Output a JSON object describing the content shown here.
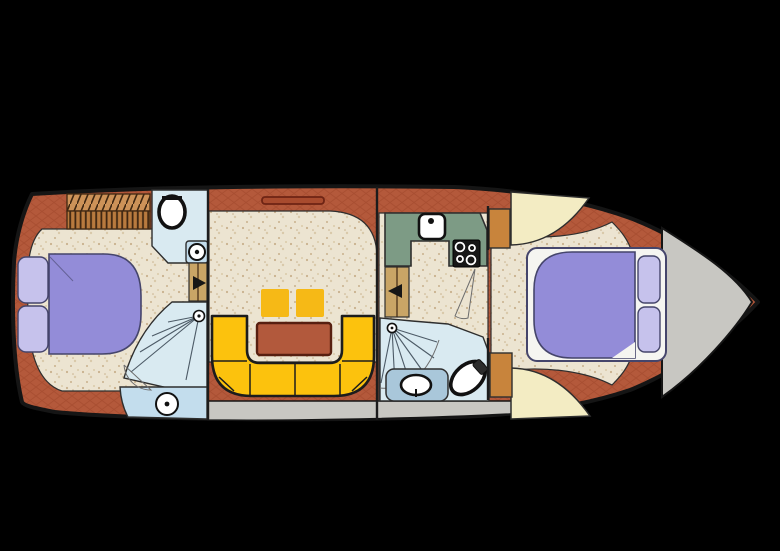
{
  "figure": {
    "kind": "yacht-deck-floor-plan",
    "orientation": "bow-right",
    "visible_text": "",
    "sections": {
      "aft_cabin": {
        "furniture": [
          "double-bed",
          "pillows",
          "louvered-steps",
          "wc-room",
          "toilet",
          "wash-basin",
          "fan-staircase",
          "shower-room",
          "deck-support"
        ]
      },
      "salon": {
        "furniture": [
          "u-shaped-sofa",
          "dinette-table",
          "two-stools",
          "vent-slot"
        ]
      },
      "galley_bathroom": {
        "furniture": [
          "galley-counter",
          "sink",
          "stove",
          "fan-staircase",
          "wash-basin-counter",
          "toilet",
          "cabinet-doors"
        ]
      },
      "bow_cabin": {
        "furniture": [
          "double-bed",
          "pillows",
          "wardrobe-wedges",
          "cabinet-doors"
        ]
      },
      "bow_deck": {
        "furniture": []
      }
    }
  },
  "palette": {
    "background": "#000000",
    "hull_outline": "#151515",
    "terracotta": "#b4593b",
    "terracotta_line": "#9a4226",
    "deck_gray": "#c8c7c2",
    "floor_beige": "#ece4d1",
    "speckle1": "#c9b18d",
    "speckle2": "#d9c9a9",
    "room_blue": "#d9eaf1",
    "shower_blue": "#c3dded",
    "counter_blue": "#a9c7da",
    "bed_purple": "#938cd8",
    "pillow_lilac": "#c6c2ec",
    "bed_frame": "#f5f5f1",
    "bed_outline": "#45456b",
    "sofa_yellow": "#fcc20d",
    "stool_yellow": "#f6b916",
    "sofa_outline": "#1c1c1c",
    "table_brown": "#b2593c",
    "table_border": "#571f10",
    "galley_green": "#7d9b85",
    "stove_black": "#161616",
    "fixture_white": "#ffffff",
    "fixture_outline": "#111111",
    "wood_tan": "#c9a566",
    "wood_mid": "#cd9258",
    "wood_deep": "#b87a3e",
    "wood_dark": "#3f2712",
    "door_orange": "#c8843c",
    "cream": "#f3ecc3",
    "outline_soft": "#2e2e2e",
    "bulkhead": "#1c1c1c",
    "swing_line": "#6d6d6d",
    "stair_line": "#4c5a66",
    "slot_fill": "#a84b2e",
    "slot_border": "#6e2414"
  }
}
